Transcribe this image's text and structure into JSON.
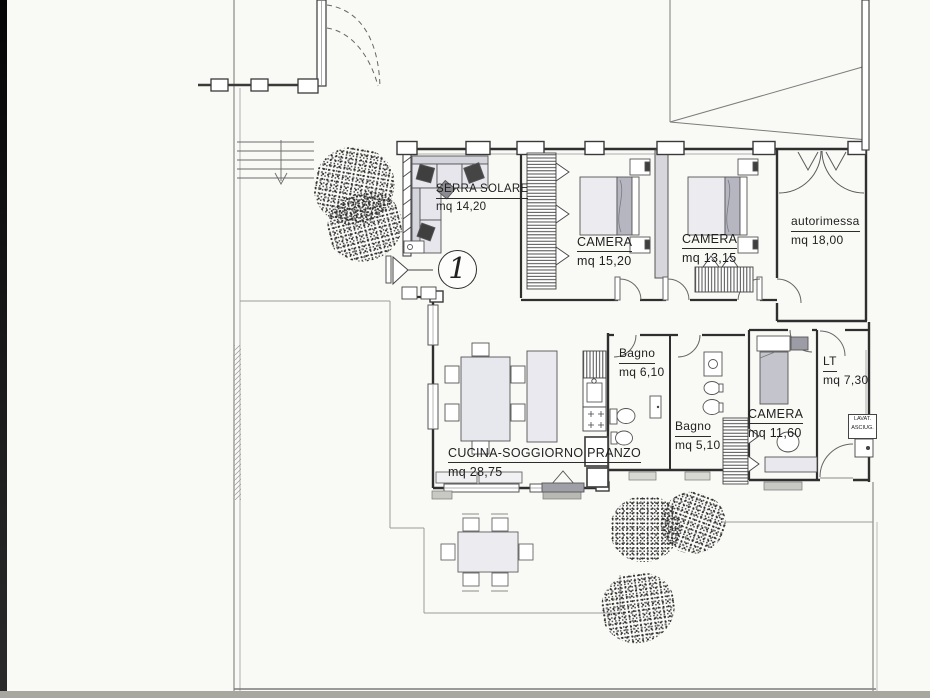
{
  "plan": {
    "unit_marker": "1",
    "rooms": {
      "serra": {
        "name": "SERRA SOLARE",
        "area": "mq 14,20"
      },
      "camera1": {
        "name": "CAMERA",
        "area": "mq 15,20"
      },
      "camera2": {
        "name": "CAMERA",
        "area": "mq 13,15"
      },
      "autorimessa": {
        "name": "autorimessa",
        "area": "mq 18,00"
      },
      "bagno1": {
        "name": "Bagno",
        "area": "mq 6,10"
      },
      "bagno2": {
        "name": "Bagno",
        "area": "mq 5,10"
      },
      "camera3": {
        "name": "CAMERA",
        "area": "mq 11,60"
      },
      "lt": {
        "name": "LT",
        "area": "mq 7,30"
      },
      "cucina": {
        "name": "CUCINA-SOGGIORNO PRANZO",
        "area": "mq 28,75"
      }
    },
    "appliance_box": {
      "line1": "LAVAT.",
      "line2": "ASCIUG."
    },
    "colors": {
      "paper": "#f9f9f5",
      "ink": "#2f2f2f",
      "furniture_fill": "#e7e7ee",
      "partition_fill": "#d6d6dc",
      "dark_accent": "#3f3f3f"
    }
  }
}
